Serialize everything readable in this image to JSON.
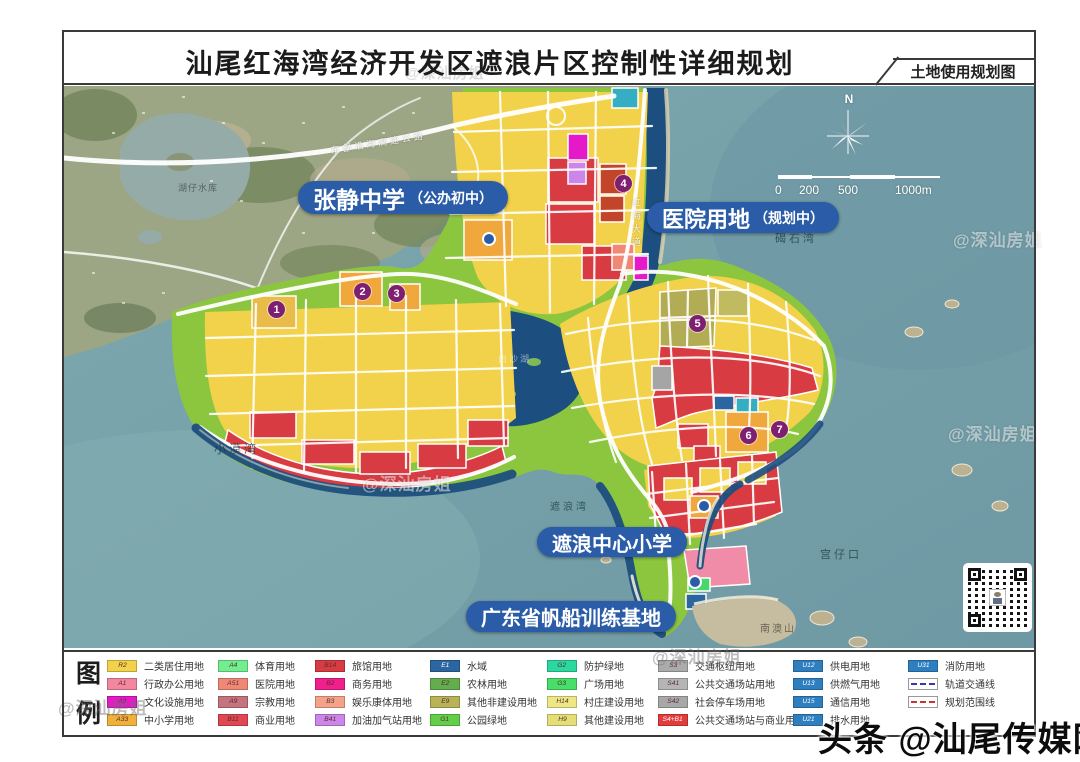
{
  "page": {
    "title": "汕尾红海湾经济开发区遮浪片区控制性详细规划",
    "map_type_label": "土地使用规划图"
  },
  "annotations": {
    "zhangjing_school": {
      "name": "张静中学",
      "suffix": "（公办初中）"
    },
    "hospital": {
      "name": "医院用地",
      "suffix": "（规划中）"
    },
    "zhelang_primary": {
      "name": "遮浪中心小学"
    },
    "sailing_base": {
      "name": "广东省帆船训练基地"
    }
  },
  "markers": [
    "1",
    "2",
    "3",
    "4",
    "5",
    "6",
    "7"
  ],
  "places": {
    "reservoir": "湖仔水库",
    "west_bay": "小漠湾",
    "east_bay": "碣石湾",
    "lake": "白沙湖",
    "south_bay": "遮浪湾",
    "cape": "宫仔口",
    "hill": "南澳山"
  },
  "roads": {
    "highway": "东部沿海高速公路",
    "avenue": "红海大道"
  },
  "compass": {
    "north": "N"
  },
  "scale_bar": {
    "ticks": [
      "0",
      "200",
      "500",
      "1000m"
    ]
  },
  "legend": {
    "title_chars": [
      "图",
      "例"
    ],
    "items": [
      {
        "code": "R2",
        "label": "二类居住用地",
        "color": "#F2D24B",
        "code_style": "dark",
        "type": "swatch"
      },
      {
        "code": "A1",
        "label": "行政办公用地",
        "color": "#F2879F",
        "code_style": "dark",
        "type": "swatch"
      },
      {
        "code": "A2",
        "label": "文化设施用地",
        "color": "#E619C8",
        "code_style": "dark",
        "type": "swatch"
      },
      {
        "code": "A33",
        "label": "中小学用地",
        "color": "#F0B03C",
        "code_style": "dark",
        "type": "swatch"
      },
      {
        "code": "A4",
        "label": "体育用地",
        "color": "#72EE8E",
        "code_style": "dark",
        "type": "swatch"
      },
      {
        "code": "A51",
        "label": "医院用地",
        "color": "#F08876",
        "code_style": "dark",
        "type": "swatch"
      },
      {
        "code": "A9",
        "label": "宗教用地",
        "color": "#C4737F",
        "code_style": "dark",
        "type": "swatch"
      },
      {
        "code": "B11",
        "label": "商业用地",
        "color": "#E04751",
        "code_style": "dark",
        "type": "swatch"
      },
      {
        "code": "B14",
        "label": "旅馆用地",
        "color": "#D93B43",
        "code_style": "dark",
        "type": "swatch"
      },
      {
        "code": "B2",
        "label": "商务用地",
        "color": "#F01F8C",
        "code_style": "dark",
        "type": "swatch"
      },
      {
        "code": "B3",
        "label": "娱乐康体用地",
        "color": "#F5A388",
        "code_style": "dark",
        "type": "swatch"
      },
      {
        "code": "B41",
        "label": "加油加气站用地",
        "color": "#CC85E8",
        "code_style": "dark",
        "type": "swatch"
      },
      {
        "code": "E1",
        "label": "水域",
        "color": "#2C66A0",
        "code_style": "light",
        "type": "swatch"
      },
      {
        "code": "E2",
        "label": "农林用地",
        "color": "#63AD4F",
        "code_style": "dark",
        "type": "swatch"
      },
      {
        "code": "E9",
        "label": "其他非建设用地",
        "color": "#B7B356",
        "code_style": "dark",
        "type": "swatch"
      },
      {
        "code": "G1",
        "label": "公园绿地",
        "color": "#63CE49",
        "code_style": "dark",
        "type": "swatch"
      },
      {
        "code": "G2",
        "label": "防护绿地",
        "color": "#2BD9A0",
        "code_style": "dark",
        "type": "swatch"
      },
      {
        "code": "G3",
        "label": "广场用地",
        "color": "#47DE69",
        "code_style": "dark",
        "type": "swatch"
      },
      {
        "code": "H14",
        "label": "村庄建设用地",
        "color": "#EDE785",
        "code_style": "dark",
        "type": "swatch"
      },
      {
        "code": "H9",
        "label": "其他建设用地",
        "color": "#E4DE77",
        "code_style": "dark",
        "type": "swatch"
      },
      {
        "code": "S3",
        "label": "交通枢纽用地",
        "color": "#ABABAB",
        "code_style": "dark",
        "type": "swatch"
      },
      {
        "code": "S41",
        "label": "公共交通场站用地",
        "color": "#B5B5B5",
        "code_style": "dark",
        "type": "swatch"
      },
      {
        "code": "S42",
        "label": "社会停车场用地",
        "color": "#A8A8A8",
        "code_style": "dark",
        "type": "swatch"
      },
      {
        "code": "S4+B1",
        "label": "公共交通场站与商业用地",
        "color": "#E23C3C",
        "code_style": "light",
        "type": "swatch"
      },
      {
        "code": "U12",
        "label": "供电用地",
        "color": "#2E7FC0",
        "code_style": "light",
        "type": "swatch"
      },
      {
        "code": "U13",
        "label": "供燃气用地",
        "color": "#2E7FC0",
        "code_style": "light",
        "type": "swatch"
      },
      {
        "code": "U15",
        "label": "通信用地",
        "color": "#2E7FC0",
        "code_style": "light",
        "type": "swatch"
      },
      {
        "code": "U21",
        "label": "排水用地",
        "color": "#2E7FC0",
        "code_style": "light",
        "type": "swatch"
      },
      {
        "code": "U31",
        "label": "消防用地",
        "color": "#2E7FC0",
        "code_style": "light",
        "type": "swatch"
      },
      {
        "code": "",
        "label": "轨道交通线",
        "color": "#3939B0",
        "code_style": "dark",
        "type": "line"
      },
      {
        "code": "",
        "label": "规划范围线",
        "color": "#CC3333",
        "code_style": "dark",
        "type": "line"
      }
    ]
  },
  "watermarks": {
    "social": "@深汕房姐",
    "publisher": "头条 @汕尾传媒网"
  },
  "colors": {
    "label_pill": "#2B5CA8",
    "marker": "#7E1F72",
    "water": "#1C4E7F",
    "park": "#8CC63F",
    "residential": "#F2D24B",
    "commercial": "#D93B43",
    "sea": "#74A0AA"
  }
}
